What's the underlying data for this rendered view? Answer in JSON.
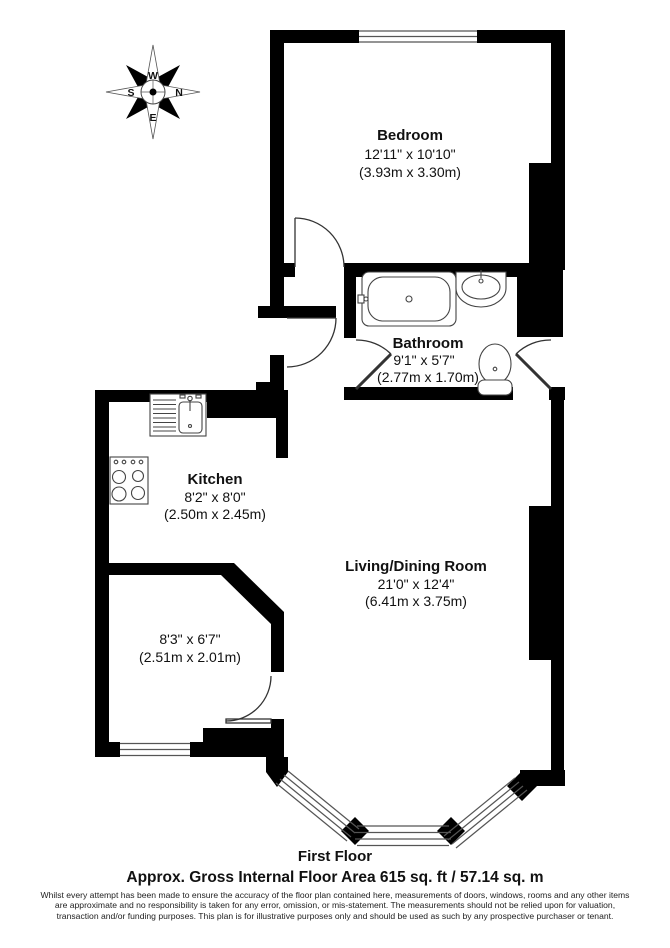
{
  "compass": {
    "top": "W",
    "right": "N",
    "bottom": "E",
    "left": "S"
  },
  "rooms": {
    "bedroom": {
      "name": "Bedroom",
      "dims": "12'11\" x 10'10\"",
      "metric": "(3.93m x 3.30m)"
    },
    "bathroom": {
      "name": "Bathroom",
      "dims": "9'1\" x 5'7\"",
      "metric": "(2.77m x 1.70m)"
    },
    "kitchen": {
      "name": "Kitchen",
      "dims": "8'2\" x 8'0\"",
      "metric": "(2.50m x 2.45m)"
    },
    "living": {
      "name": "Living/Dining Room",
      "dims": "21'0\" x 12'4\"",
      "metric": "(6.41m x 3.75m)"
    },
    "store": {
      "dims": "8'3\" x 6'7\"",
      "metric": "(2.51m x 2.01m)"
    }
  },
  "footer": {
    "floor": "First Floor",
    "area": "Approx. Gross Internal Floor Area 615 sq. ft / 57.14 sq. m",
    "disclaimer": "Whilst every attempt has been made to ensure the accuracy of the floor plan contained here, measurements of doors, windows, rooms and any other items are approximate and no responsibility is taken for any error, omission, or mis-statement. The measurements should not be relied upon for valuation, transaction and/or funding purposes. This plan is for illustrative purposes only and should be used as such by any prospective purchaser or tenant."
  },
  "colors": {
    "wall": "#000000",
    "fixture_line": "#444444"
  }
}
